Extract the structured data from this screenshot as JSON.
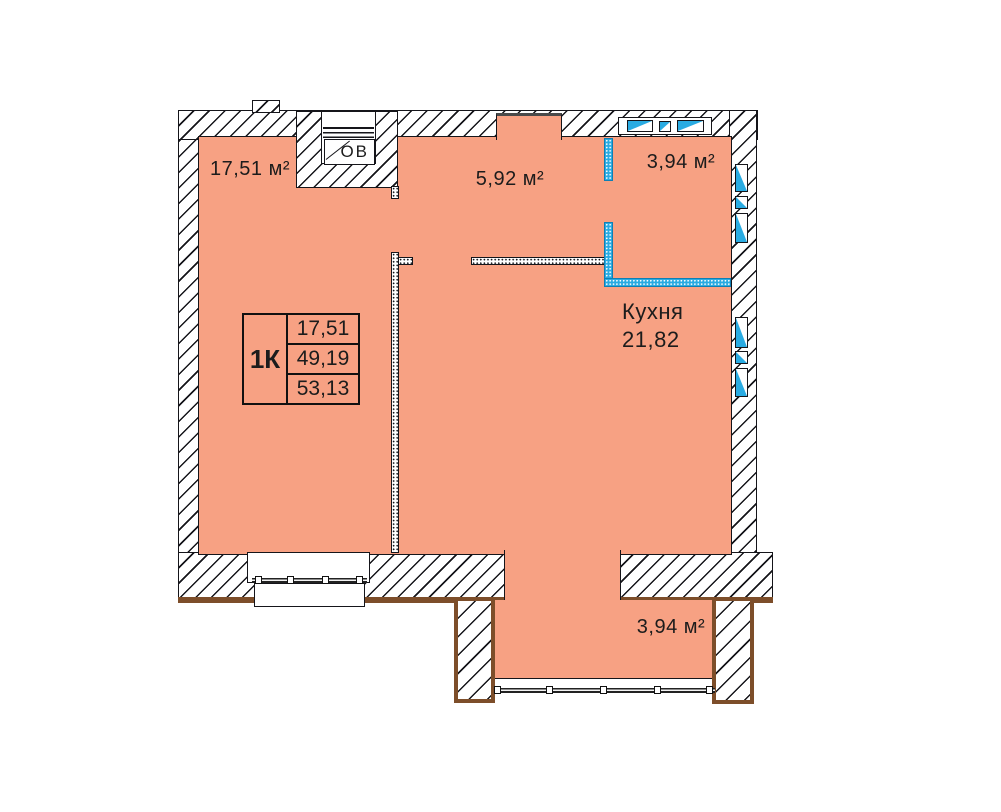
{
  "plan": {
    "rooms": {
      "living": {
        "area": "17,51 м²"
      },
      "hall": {
        "area": "5,92 м²"
      },
      "entry": {
        "area": "3,94 м²"
      },
      "kitchen": {
        "name": "Кухня",
        "area": "21,82"
      },
      "balcony": {
        "area": "3,94 м²"
      }
    },
    "shaft": {
      "label": "ОВ"
    },
    "legend": {
      "type": "1К",
      "rows": [
        "17,51",
        "49,19",
        "53,13"
      ]
    },
    "colors": {
      "floor": "#F7A183",
      "glass": "#29ABE2",
      "exterior_trim": "#7D4E2A"
    }
  }
}
